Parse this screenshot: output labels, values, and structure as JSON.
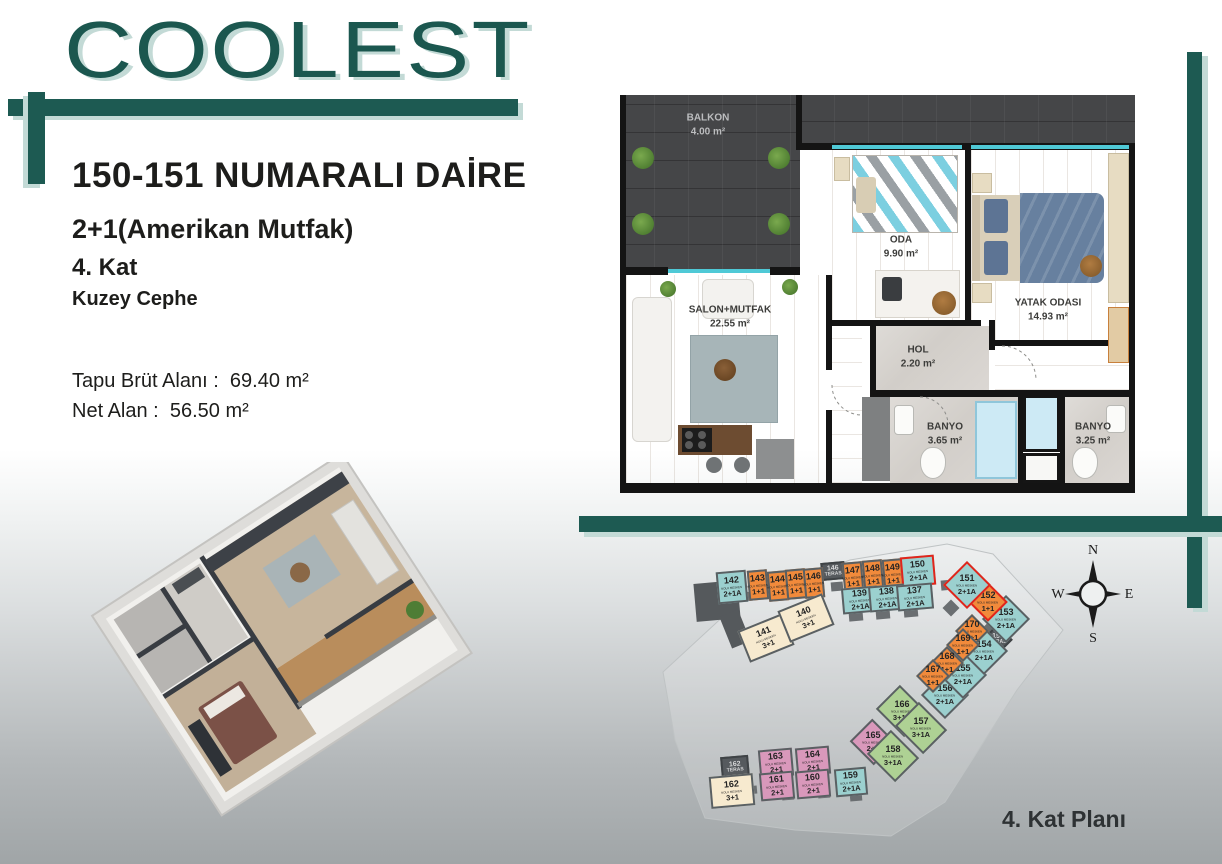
{
  "brand": {
    "logo_text": "COOLEST",
    "accent": "#1d5a52",
    "accent_light": "#c3dad6"
  },
  "info": {
    "title": "150-151 NUMARALI DAİRE",
    "type_line": "2+1(Amerikan Mutfak)",
    "floor_line": "4. Kat",
    "facade_line": "Kuzey Cephe",
    "gross_label": "Tapu Brüt Alanı :",
    "gross_value": "69.40 m²",
    "net_label": "Net Alan :",
    "net_value": "56.50 m²"
  },
  "floorplan": {
    "rooms": [
      {
        "name": "BALKON",
        "area": "4.00 m²"
      },
      {
        "name": "SALON+MUTFAK",
        "area": "22.55 m²"
      },
      {
        "name": "ODA",
        "area": "9.90 m²"
      },
      {
        "name": "YATAK ODASI",
        "area": "14.93 m²"
      },
      {
        "name": "HOL",
        "area": "2.20 m²"
      },
      {
        "name": "BANYO",
        "area": "3.65 m²"
      },
      {
        "name": "BANYO",
        "area": "3.25 m²"
      }
    ],
    "window_color": "#4fc9d6"
  },
  "keyplan": {
    "caption": "4. Kat Planı",
    "sub_label": "NOLU MESKEN",
    "compass": {
      "n": "N",
      "e": "E",
      "s": "S",
      "w": "W"
    },
    "highlight_color": "#e1251b",
    "colors": {
      "teal": "#9bd0cf",
      "orange": "#f18a3b",
      "cream": "#f7eacf",
      "pink": "#d998bb",
      "green": "#aed194",
      "dark": "#565a5e"
    },
    "units": [
      {
        "num": "146",
        "type": "TERAS",
        "color": "dark",
        "teras": true,
        "x": 176,
        "y": 22,
        "w": 24,
        "h": 18,
        "rot": -5
      },
      {
        "num": "162",
        "type": "TERAS",
        "color": "dark",
        "teras": true,
        "x": 76,
        "y": 216,
        "w": 28,
        "h": 22,
        "rot": -5
      },
      {
        "num": "153",
        "type": "TERAS",
        "color": "dark",
        "teras": true,
        "x": 342,
        "y": 89,
        "w": 22,
        "h": 20,
        "rot": 45
      },
      {
        "num": "142",
        "type": "2+1A",
        "color": "teal",
        "x": 72,
        "y": 31,
        "w": 30,
        "h": 32,
        "rot": -5
      },
      {
        "num": "143",
        "type": "1+1",
        "color": "orange",
        "x": 103,
        "y": 30,
        "w": 20,
        "h": 30,
        "rot": -5
      },
      {
        "num": "144",
        "type": "1+1",
        "color": "orange",
        "x": 123,
        "y": 31,
        "w": 20,
        "h": 30,
        "rot": -5
      },
      {
        "num": "145",
        "type": "1+1",
        "color": "orange",
        "x": 141,
        "y": 29,
        "w": 20,
        "h": 30,
        "rot": -5
      },
      {
        "num": "146",
        "type": "1+1",
        "color": "orange",
        "x": 159,
        "y": 28,
        "w": 20,
        "h": 30,
        "rot": -5
      },
      {
        "num": "147",
        "type": "1+1",
        "color": "orange",
        "x": 198,
        "y": 22,
        "w": 20,
        "h": 30,
        "rot": -5
      },
      {
        "num": "148",
        "type": "1+1",
        "color": "orange",
        "x": 218,
        "y": 20,
        "w": 20,
        "h": 30,
        "rot": -5
      },
      {
        "num": "149",
        "type": "1+1",
        "color": "orange",
        "x": 238,
        "y": 19,
        "w": 20,
        "h": 30,
        "rot": -5
      },
      {
        "num": "150",
        "type": "2+1A",
        "color": "teal",
        "hl": true,
        "x": 256,
        "y": 16,
        "w": 34,
        "h": 30,
        "rot": -5
      },
      {
        "num": "139",
        "type": "2+1A",
        "color": "teal",
        "x": 197,
        "y": 47,
        "w": 36,
        "h": 26,
        "rot": -5
      },
      {
        "num": "138",
        "type": "2+1A",
        "color": "teal",
        "x": 224,
        "y": 45,
        "w": 36,
        "h": 26,
        "rot": -5
      },
      {
        "num": "137",
        "type": "2+1A",
        "color": "teal",
        "x": 252,
        "y": 44,
        "w": 36,
        "h": 26,
        "rot": -5
      },
      {
        "num": "141",
        "type": "3+1",
        "color": "cream",
        "x": 97,
        "y": 81,
        "w": 48,
        "h": 34,
        "rot": -22
      },
      {
        "num": "140",
        "type": "3+1",
        "color": "cream",
        "x": 137,
        "y": 61,
        "w": 48,
        "h": 34,
        "rot": -22
      },
      {
        "num": "156",
        "type": "2+1A",
        "color": "teal",
        "x": 283,
        "y": 138,
        "w": 34,
        "h": 34,
        "rot": 45
      },
      {
        "num": "155",
        "type": "2+1A",
        "color": "teal",
        "x": 301,
        "y": 118,
        "w": 34,
        "h": 34,
        "rot": 45
      },
      {
        "num": "154",
        "type": "2+1A",
        "color": "teal",
        "x": 322,
        "y": 94,
        "w": 34,
        "h": 34,
        "rot": 45
      },
      {
        "num": "153",
        "type": "2+1A",
        "color": "teal",
        "x": 344,
        "y": 62,
        "w": 34,
        "h": 34,
        "rot": 45
      },
      {
        "num": "152",
        "type": "1+1",
        "color": "orange",
        "hl": true,
        "x": 329,
        "y": 48,
        "w": 28,
        "h": 28,
        "rot": 45
      },
      {
        "num": "151",
        "type": "2+1A",
        "color": "teal",
        "hl": true,
        "x": 305,
        "y": 28,
        "w": 34,
        "h": 34,
        "rot": 45
      },
      {
        "num": "170",
        "type": "1+1",
        "color": "orange",
        "x": 315,
        "y": 79,
        "w": 24,
        "h": 24,
        "rot": 45
      },
      {
        "num": "169",
        "type": "1+1",
        "color": "orange",
        "x": 306,
        "y": 93,
        "w": 24,
        "h": 24,
        "rot": 45
      },
      {
        "num": "168",
        "type": "1+1",
        "color": "orange",
        "x": 290,
        "y": 111,
        "w": 24,
        "h": 24,
        "rot": 45
      },
      {
        "num": "167",
        "type": "1+1",
        "color": "orange",
        "x": 276,
        "y": 124,
        "w": 24,
        "h": 24,
        "rot": 45
      },
      {
        "num": "166",
        "type": "3+1A",
        "color": "green",
        "x": 237,
        "y": 154,
        "w": 40,
        "h": 34,
        "rot": 45
      },
      {
        "num": "157",
        "type": "3+1A",
        "color": "green",
        "x": 256,
        "y": 171,
        "w": 40,
        "h": 34,
        "rot": 45
      },
      {
        "num": "165",
        "type": "2+1",
        "color": "pink",
        "x": 211,
        "y": 186,
        "w": 34,
        "h": 32,
        "rot": 45
      },
      {
        "num": "158",
        "type": "3+1A",
        "color": "green",
        "x": 228,
        "y": 199,
        "w": 40,
        "h": 34,
        "rot": 45
      },
      {
        "num": "163",
        "type": "2+1",
        "color": "pink",
        "x": 114,
        "y": 209,
        "w": 34,
        "h": 28,
        "rot": -5
      },
      {
        "num": "164",
        "type": "2+1",
        "color": "pink",
        "x": 151,
        "y": 207,
        "w": 34,
        "h": 28,
        "rot": -5
      },
      {
        "num": "162",
        "type": "3+1",
        "color": "cream",
        "x": 65,
        "y": 235,
        "w": 44,
        "h": 32,
        "rot": -5
      },
      {
        "num": "161",
        "type": "2+1",
        "color": "pink",
        "x": 115,
        "y": 232,
        "w": 34,
        "h": 28,
        "rot": -5
      },
      {
        "num": "160",
        "type": "2+1",
        "color": "pink",
        "x": 151,
        "y": 230,
        "w": 34,
        "h": 28,
        "rot": -5
      },
      {
        "num": "159",
        "type": "2+1A",
        "color": "teal",
        "x": 190,
        "y": 228,
        "w": 32,
        "h": 28,
        "rot": -5
      }
    ]
  }
}
